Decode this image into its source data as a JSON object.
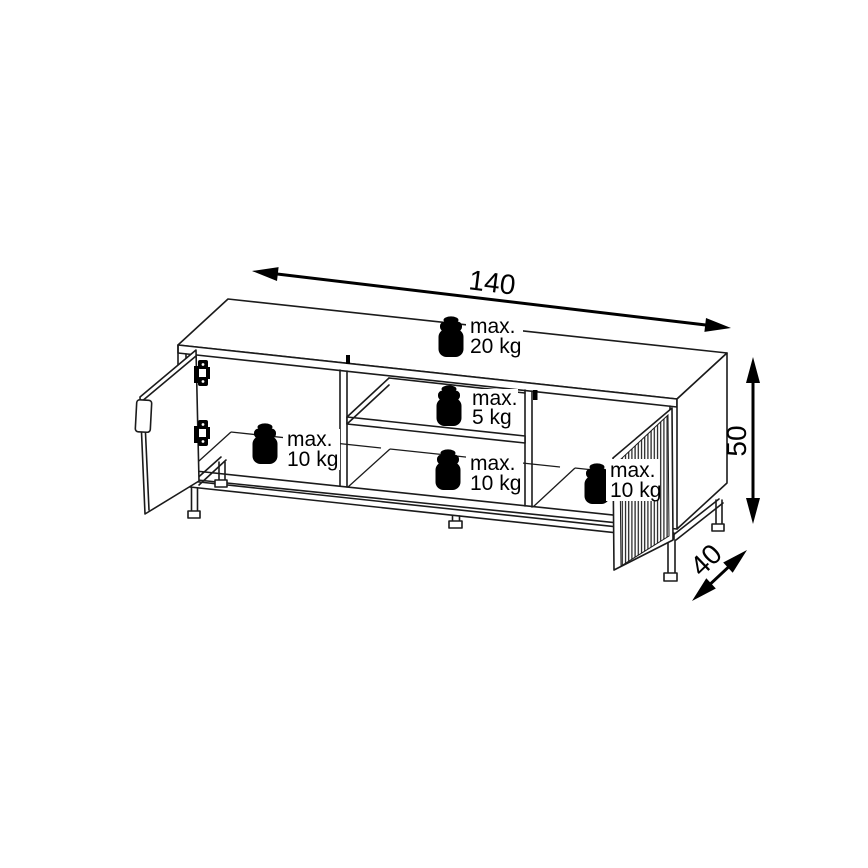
{
  "diagram": {
    "kind": "furniture-assembly-dimension-drawing",
    "dimensions": {
      "width": "140",
      "height": "50",
      "depth": "40"
    },
    "load_capacities": {
      "top_panel": {
        "line1": "max.",
        "line2": "20 kg"
      },
      "middle_shelf": {
        "line1": "max.",
        "line2": "5 kg"
      },
      "left_compartment": {
        "line1": "max.",
        "line2": "10 kg"
      },
      "middle_bottom": {
        "line1": "max.",
        "line2": "10 kg"
      },
      "right_compartment": {
        "line1": "max.",
        "line2": "10 kg"
      }
    },
    "colors": {
      "line": "#1b1b1b",
      "background": "#ffffff",
      "weight_icon": "#000000"
    }
  }
}
